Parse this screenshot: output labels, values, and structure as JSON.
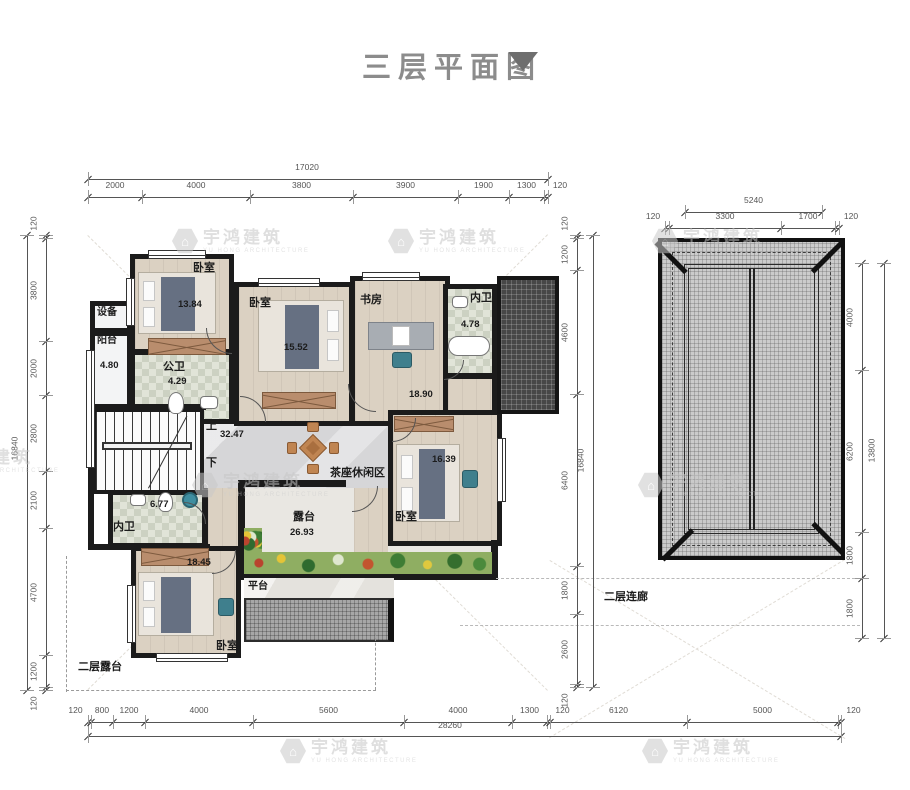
{
  "title": {
    "text": "三层平面图"
  },
  "watermark": {
    "cn": "宇鸿建筑",
    "en": "YU HONG ARCHITECTURE"
  },
  "dims": {
    "top": {
      "total": "17020",
      "segments": [
        "2000",
        "4000",
        "3800",
        "3900",
        "1900",
        "1300",
        "120"
      ]
    },
    "left": {
      "total": "16840",
      "segments": [
        "120",
        "3800",
        "2000",
        "2800",
        "2100",
        "4700",
        "1200",
        "120"
      ]
    },
    "inner_right": {
      "total": "16840",
      "segments": [
        "120",
        "1200",
        "4600",
        "6400",
        "1800",
        "2600",
        "120"
      ]
    },
    "bottom": {
      "total": "28260",
      "segments": [
        "120",
        "800",
        "1200",
        "4000",
        "5600",
        "4000",
        "1300",
        "120",
        "6120",
        "5000",
        "120"
      ]
    },
    "roof_top": {
      "total": "5240",
      "segments": [
        "120",
        "3300",
        "1700",
        "120"
      ]
    },
    "roof_right": {
      "total": "13800",
      "segments": [
        "4000",
        "6200",
        "1800",
        "1800"
      ]
    }
  },
  "rooms": {
    "bedroom_tl": {
      "label": "卧室",
      "area": "13.84"
    },
    "bedroom_tm": {
      "label": "卧室",
      "area": "15.52"
    },
    "study": {
      "label": "书房",
      "area": "18.90"
    },
    "bath_top": {
      "label": "内卫",
      "area": "4.78"
    },
    "equipment": {
      "label": "设备"
    },
    "balcony": {
      "label": "阳台",
      "area": "4.80"
    },
    "pub_bath": {
      "label": "公卫",
      "area": "4.29"
    },
    "hall": {
      "area": "32.47",
      "tea_zone": "茶座休闲区",
      "up": "上",
      "down": "下"
    },
    "bath_mid": {
      "label": "内卫",
      "area": "6.77"
    },
    "bedroom_r": {
      "label": "卧室",
      "area": "16.39"
    },
    "terrace": {
      "label": "露台",
      "area": "26.93"
    },
    "bedroom_b": {
      "label": "卧室",
      "area": "18.45"
    },
    "platform": {
      "label": "平台"
    },
    "terrace2f": {
      "label": "二层露台"
    },
    "corridor2f": {
      "label": "二层连廊"
    }
  }
}
